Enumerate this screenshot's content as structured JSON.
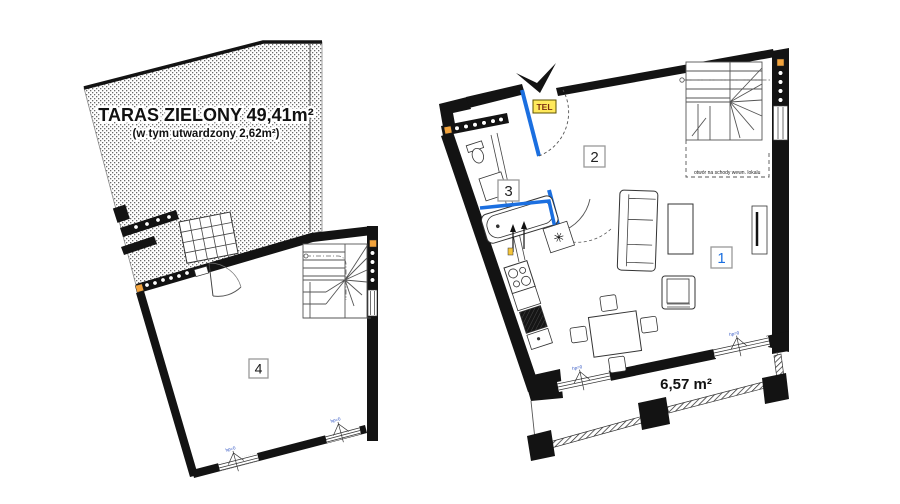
{
  "colors": {
    "wall_black": "#131313",
    "door_blue": "#1b6fe0",
    "room1_label_blue": "#1b6fe0",
    "tel_box_yellow": "#ffe95c",
    "window_end_orange": "#f2a33c"
  },
  "upper_plan": {
    "terrace_title": "TARAS ZIELONY 49,41m²",
    "terrace_subtitle": "(w tym utwardzony 2,62m²)",
    "room_label": "4",
    "window_annotation_1": "hp=0",
    "window_annotation_2": "hp=0"
  },
  "lower_plan": {
    "entry_sign": "TEL",
    "room_label_living": "1",
    "room_label_hall": "2",
    "room_label_bath": "3",
    "boiler_symbol": "✳",
    "stairs_opening_note": "otwór na schody wewn. lokalu",
    "balcony_area": "6,57 m²",
    "window_annotation_1": "hp=0",
    "window_annotation_2": "hp=0"
  }
}
